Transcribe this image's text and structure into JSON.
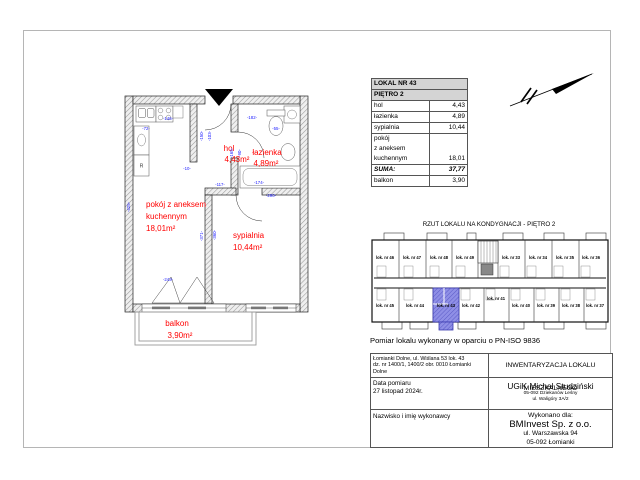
{
  "document": {
    "measurement_note": "Pomiar lokalu wykonany w oparciu o PN-ISO 9836"
  },
  "plan": {
    "rooms": {
      "hol_name": "hol",
      "hol_area": "4,43m²",
      "lazienka_name": "łazienka",
      "lazienka_area": "4,89m²",
      "pokoj_line1": "pokój z aneksem",
      "pokoj_line2": "kuchennym",
      "pokoj_area": "18,01m²",
      "sypialnia_name": "sypialnia",
      "sypialnia_area": "10,44m²",
      "balkon_name": "balkon",
      "balkon_area": "3,90m²"
    },
    "fridge_label": "R",
    "dims": {
      "top_left": "-72-",
      "top_kitchen": "-146-",
      "top_entry": "-182-",
      "kitchen_stub": "-10-",
      "kitchen_v1": "-150-",
      "kitchen_v2": "-103-",
      "hol_width": "-117-",
      "bedroom_door": "-290-",
      "tub": "-174-",
      "washer": "-55-",
      "bath_v1": "-165-",
      "bath_v2": "-90-",
      "left_wall": "-425-",
      "wall_v1": "-371-",
      "wall_v2": "-360-",
      "balcony_door": "-243-"
    },
    "colors": {
      "room_label": "#ff0000",
      "dimension": "#2020ff"
    }
  },
  "area_table": {
    "title": "LOKAL NR 43",
    "floor": "PIĘTRO 2",
    "rows": [
      {
        "label": "hol",
        "value": "4,43"
      },
      {
        "label": "łazienka",
        "value": "4,89"
      },
      {
        "label": "sypialnia",
        "value": "10,44"
      }
    ],
    "pokoj": {
      "line1": "pokój",
      "line2": "z aneksem",
      "line3": "kuchennym",
      "value": "18,01"
    },
    "suma": {
      "label": "SUMA:",
      "value": "37,77"
    },
    "balkon": {
      "label": "balkon",
      "value": "3,90"
    }
  },
  "key_plan": {
    "title": "RZUT LOKALU NA KONDYGNACJI - PIĘTRO 2",
    "top_units": [
      "lok. nr 46",
      "lok. nr 47",
      "lok. nr 48",
      "lok. nr 49",
      "lok. nr 33",
      "lok. nr 34",
      "lok. nr 35",
      "lok. nr 36"
    ],
    "bottom_units": [
      "lok. nr 45",
      "lok. nr 44",
      "lok. nr 43",
      "lok. nr 42",
      "lok. nr 41",
      "lok. nr 40",
      "lok. nr 39",
      "lok. nr 38",
      "lok. nr 37"
    ],
    "highlight_unit": "lok. nr 43",
    "highlight_color": "#8a8ae0"
  },
  "info_table": {
    "address_line1": "Łomianki Dolne, ul. Wiślana 53 lok. 43",
    "address_line2": "dz. nr 1400/1, 1400/2 obr. 0010 Łomianki Dolne",
    "doc_type": "INWENTARYZACJA LOKALU MIESZKALNEGO",
    "date_label": "Data pomiaru",
    "date_value": "27 listopad 2024r.",
    "surveyor": "UGiK Michał Studziński",
    "surveyor_addr1": "05-092 Dziekanów Leśny",
    "surveyor_addr2": "ul. Waligóry 3A/2",
    "executor_label": "Nazwisko i imię wykonawcy",
    "client_intro": "Wykonano dla:",
    "client_name": "BMInvest Sp. z o.o.",
    "client_addr1": "ul. Warszawska 94",
    "client_addr2": "05-092 Łomianki"
  }
}
